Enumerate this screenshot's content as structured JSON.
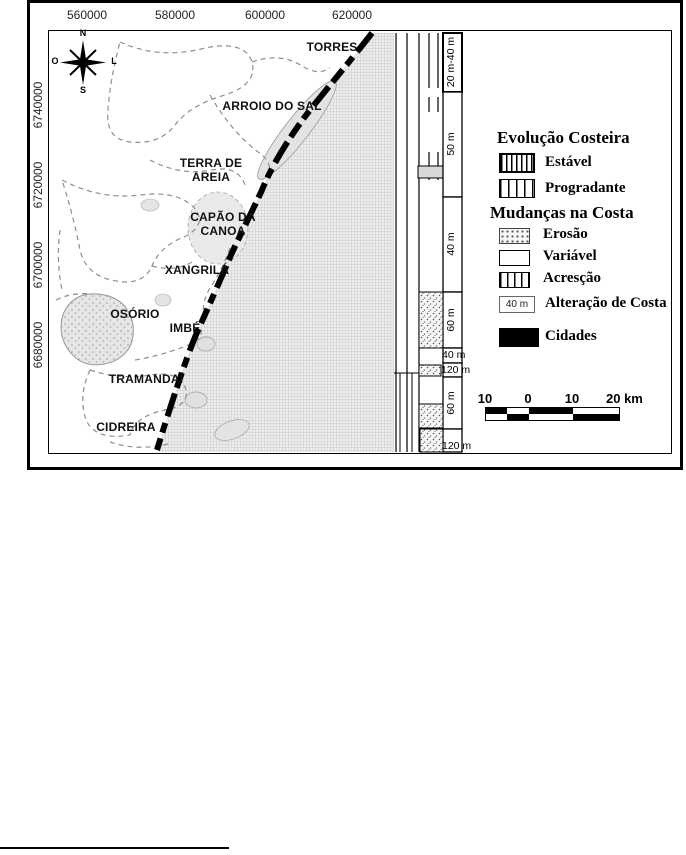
{
  "axes": {
    "top": [
      "560000",
      "580000",
      "600000",
      "620000"
    ],
    "left": [
      "6740000",
      "6720000",
      "6700000",
      "6680000"
    ]
  },
  "compass": {
    "n": "N",
    "s": "S",
    "o": "O",
    "l": "L"
  },
  "cities": {
    "torres": "TORRES",
    "arroio_do_sal": "ARROIO DO SAL",
    "terra_de_areia_l1": "TERRA DE",
    "terra_de_areia_l2": "AREIA",
    "capao_da_canoa_l1": "CAPÃO DA",
    "capao_da_canoa_l2": "CANOA",
    "xangrila": "XANGRILÁ",
    "osorio": "OSÓRIO",
    "imbe": "IMBÉ",
    "tramandai": "TRAMANDAÍ",
    "cidreira": "CIDREIRA"
  },
  "strip_labels": {
    "seg1": "20 m-40 m",
    "seg2": "50 m",
    "seg3": "40 m",
    "seg4": "60 m",
    "seg5": "40 m",
    "seg6": "120 m",
    "seg7": "60 m",
    "seg8": "120 m"
  },
  "legend": {
    "evolucao_title": "Evolução Costeira",
    "estavel": "Estável",
    "progradante": "Progradante",
    "mudancas_title": "Mudanças na Costa",
    "erosao": "Erosão",
    "variavel": "Variável",
    "acrescao": "Acresção",
    "alteracao_value": "40 m",
    "alteracao": "Alteração de Costa",
    "cidades": "Cidades"
  },
  "scalebar": {
    "labels": [
      "10",
      "0",
      "10",
      "20 km"
    ]
  },
  "colors": {
    "ink": "#000000",
    "ocean_grid": "#b5b5b5",
    "boundary": "#8f8f8f"
  }
}
